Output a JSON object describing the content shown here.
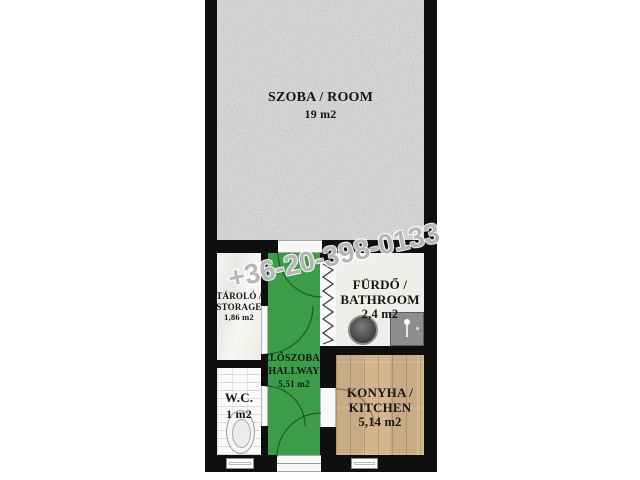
{
  "watermark": {
    "text": "+36-20-398-0133"
  },
  "rooms": {
    "szoba": {
      "name": "SZOBA / ROOM",
      "area": "19 m2"
    },
    "tarolo": {
      "name": "TÁROLÓ /",
      "name2": "STORAGE",
      "area": "1,86 m2"
    },
    "eloszoba": {
      "name": "ELŐSZOBA /",
      "name2": "HALLWAY",
      "area": "5,51 m2"
    },
    "furdo": {
      "name": "FÜRDŐ /",
      "name2": "BATHROOM",
      "area": "2,4 m2"
    },
    "wc": {
      "name": "W.C.",
      "area": "1 m2"
    },
    "konyha": {
      "name": "KONYHA /",
      "name2": "KITCHEN",
      "area": "5,14 m2"
    }
  },
  "colors": {
    "wall": "#0f0f0f",
    "hallway_green": "#3b9c49",
    "kitchen_wood": "#d3b68e",
    "room_gray": "#a6a6a6",
    "bathroom_floor": "#efeeeb",
    "watermark_gray": "#949494"
  },
  "icons": [
    "toilet-icon",
    "washbasin-icon",
    "shower-icon",
    "folding-door-icon",
    "door-swing-arc",
    "door-opening",
    "window-frame"
  ]
}
